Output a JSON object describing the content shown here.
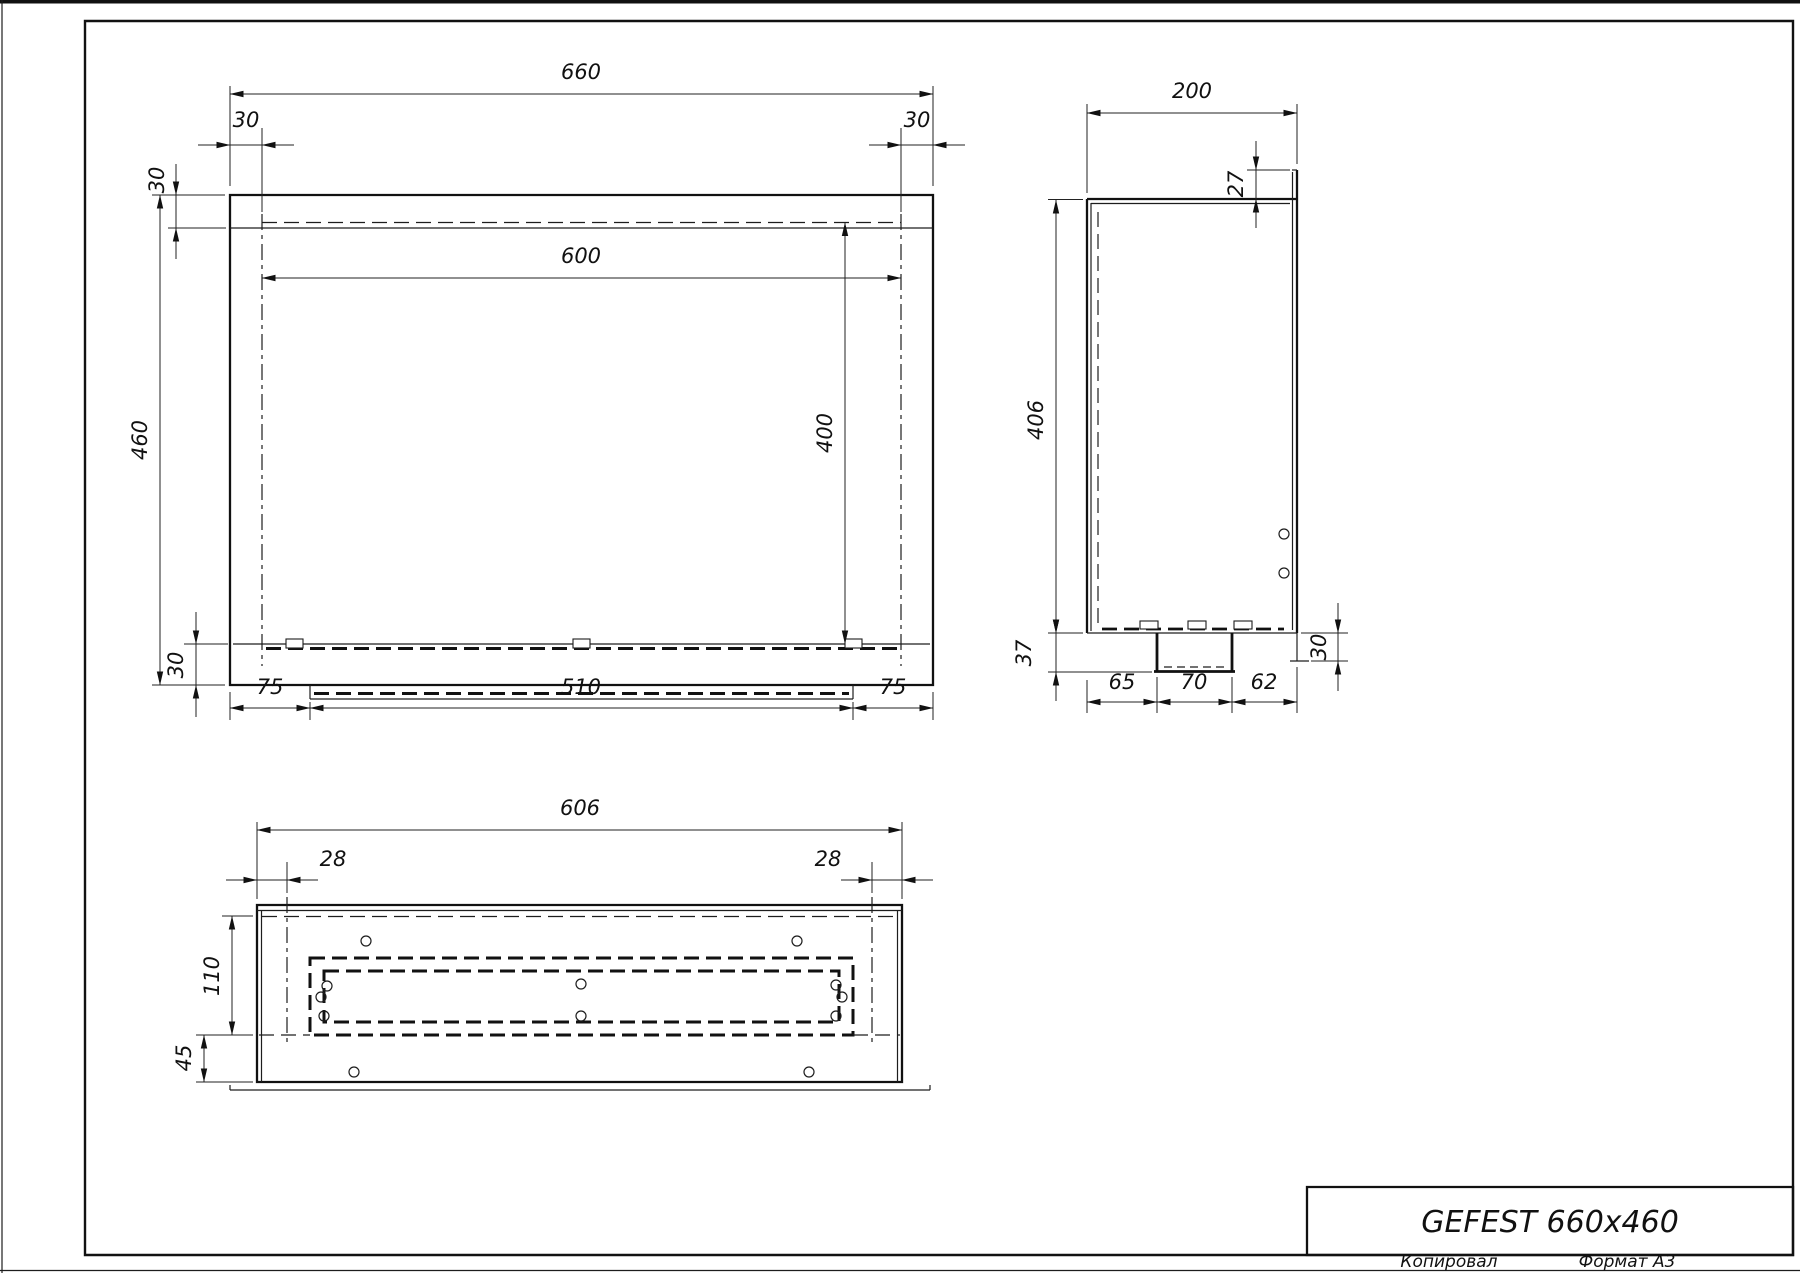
{
  "title_block": {
    "model": "GEFEST 660x460"
  },
  "footer": {
    "copied": "Копировал",
    "format": "Формат А3"
  },
  "front_view": {
    "overall_width": "660",
    "offset_left": "30",
    "offset_right": "30",
    "offset_top": "30",
    "opening_width": "600",
    "overall_height": "460",
    "opening_height": "400",
    "offset_bottom": "30",
    "bottom_left": "75",
    "tray_width": "510",
    "bottom_right": "75"
  },
  "side_view": {
    "overall_depth": "200",
    "lip_height": "27",
    "body_height": "406",
    "tray_depth": "37",
    "bottom_front": "65",
    "tray_width": "70",
    "bottom_back": "62",
    "flange_drop": "30"
  },
  "bottom_view": {
    "flange_width": "606",
    "offset_left": "28",
    "offset_right": "28",
    "opening_depth": "110",
    "front_band": "45"
  }
}
